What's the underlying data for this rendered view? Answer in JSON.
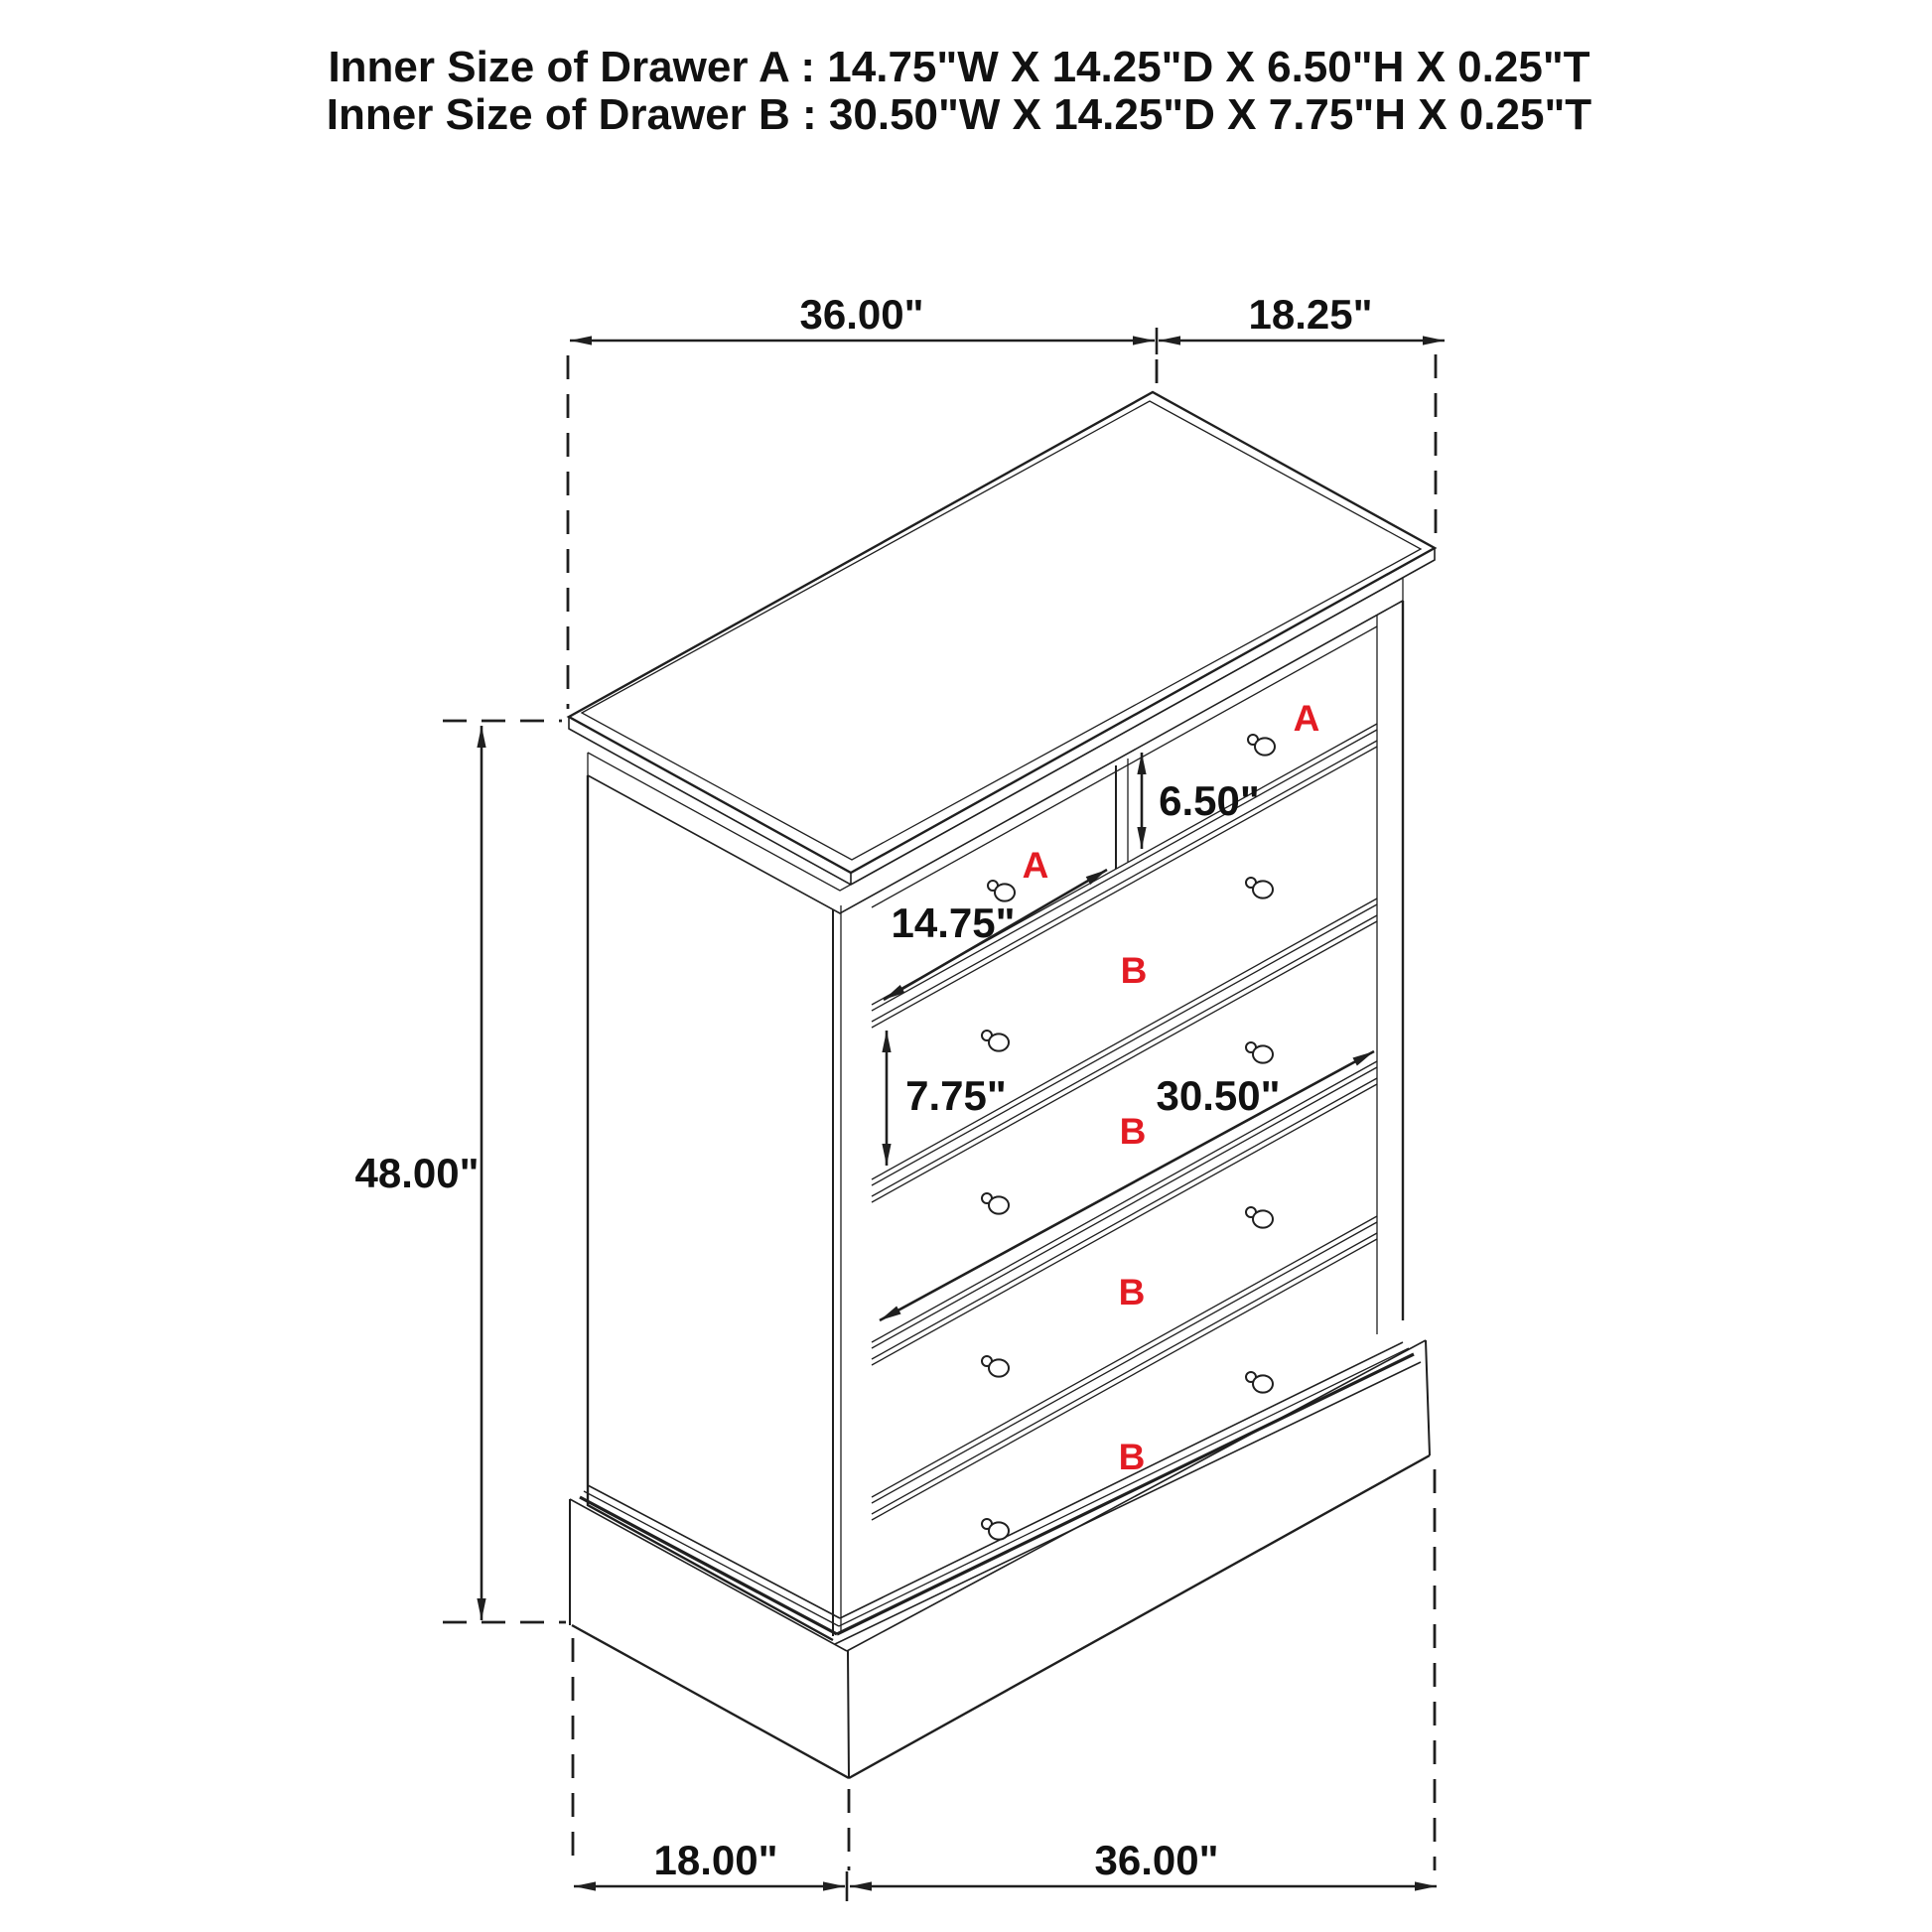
{
  "title": {
    "line1": "Inner Size of Drawer A : 14.75\"W X 14.25\"D X 6.50\"H X 0.25\"T",
    "line2": "Inner Size of Drawer B : 30.50\"W X 14.25\"D X 7.75\"H X 0.25\"T"
  },
  "dimensions": {
    "top_width": "36.00\"",
    "top_depth": "18.25\"",
    "overall_height": "48.00\"",
    "drawer_a_inner_height": "6.50\"",
    "drawer_a_inner_width": "14.75\"",
    "drawer_b_inner_height": "7.75\"",
    "drawer_b_inner_width": "30.50\"",
    "base_depth": "18.00\"",
    "base_width": "36.00\""
  },
  "drawer_labels": {
    "a_left": "A",
    "a_right": "A",
    "b1": "B",
    "b2": "B",
    "b3": "B",
    "b4": "B"
  },
  "colors": {
    "line": "#1f1f1f",
    "label_red": "#e31b23",
    "background": "#ffffff"
  }
}
